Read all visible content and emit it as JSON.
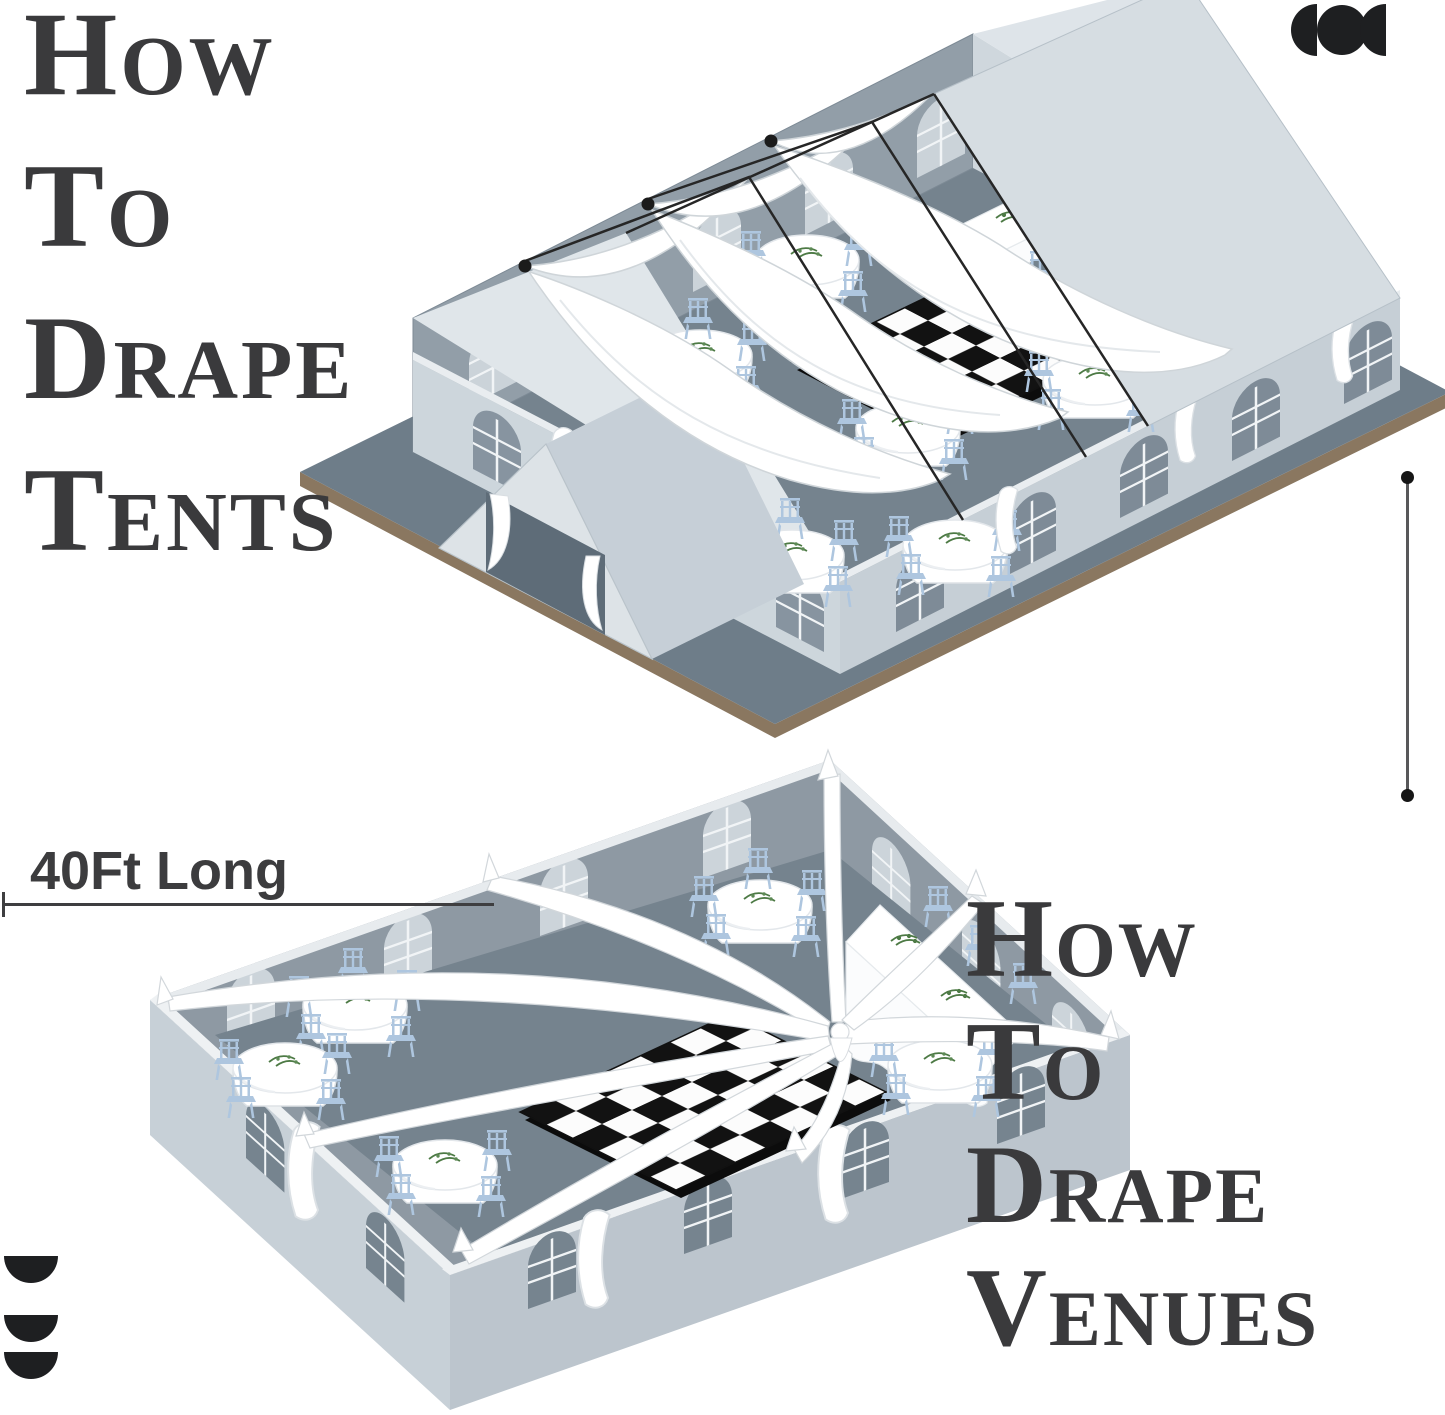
{
  "page": {
    "width": 1445,
    "height": 1415,
    "background": "#ffffff"
  },
  "headings": {
    "tents": {
      "lines": [
        "How",
        "To",
        "Drape",
        "Tents"
      ]
    },
    "venues": {
      "lines": [
        "How",
        "To",
        "Drape",
        "Venues"
      ]
    }
  },
  "dimension": {
    "length_label": "40Ft Long"
  },
  "logos": {
    "top_right": "half-disc-circle-half-disc-mark",
    "bottom_left": "three-half-discs-mark"
  },
  "colors": {
    "heading_text": "#3a3a3c",
    "label_text": "#3c3c3e",
    "dimension_line": "#3e3e40",
    "logo_mark": "#1e1f21",
    "floor_slate": "#75838e",
    "wall_exterior": "#c6cfd6",
    "wall_interior": "#929ea8",
    "roof_light": "#d6dde2",
    "drape_white": "#ffffff",
    "chair_blue": "#aec6df",
    "checker_dark": "#121212",
    "checker_light": "#fcfcfc",
    "greenery": "#4d7a45",
    "platform_edge_brown": "#8a7760"
  },
  "illustrations": {
    "tent": {
      "label": "isometric draped frame tent",
      "ceiling_drapes": 3,
      "round_tables": 6,
      "banquet_tables": 1,
      "dance_floor": "black-white checker"
    },
    "venue": {
      "label": "isometric draped venue room",
      "radial_drapes": 8,
      "round_tables": 5,
      "banquet_tables": 1,
      "dance_floor": "black-white checker"
    }
  }
}
